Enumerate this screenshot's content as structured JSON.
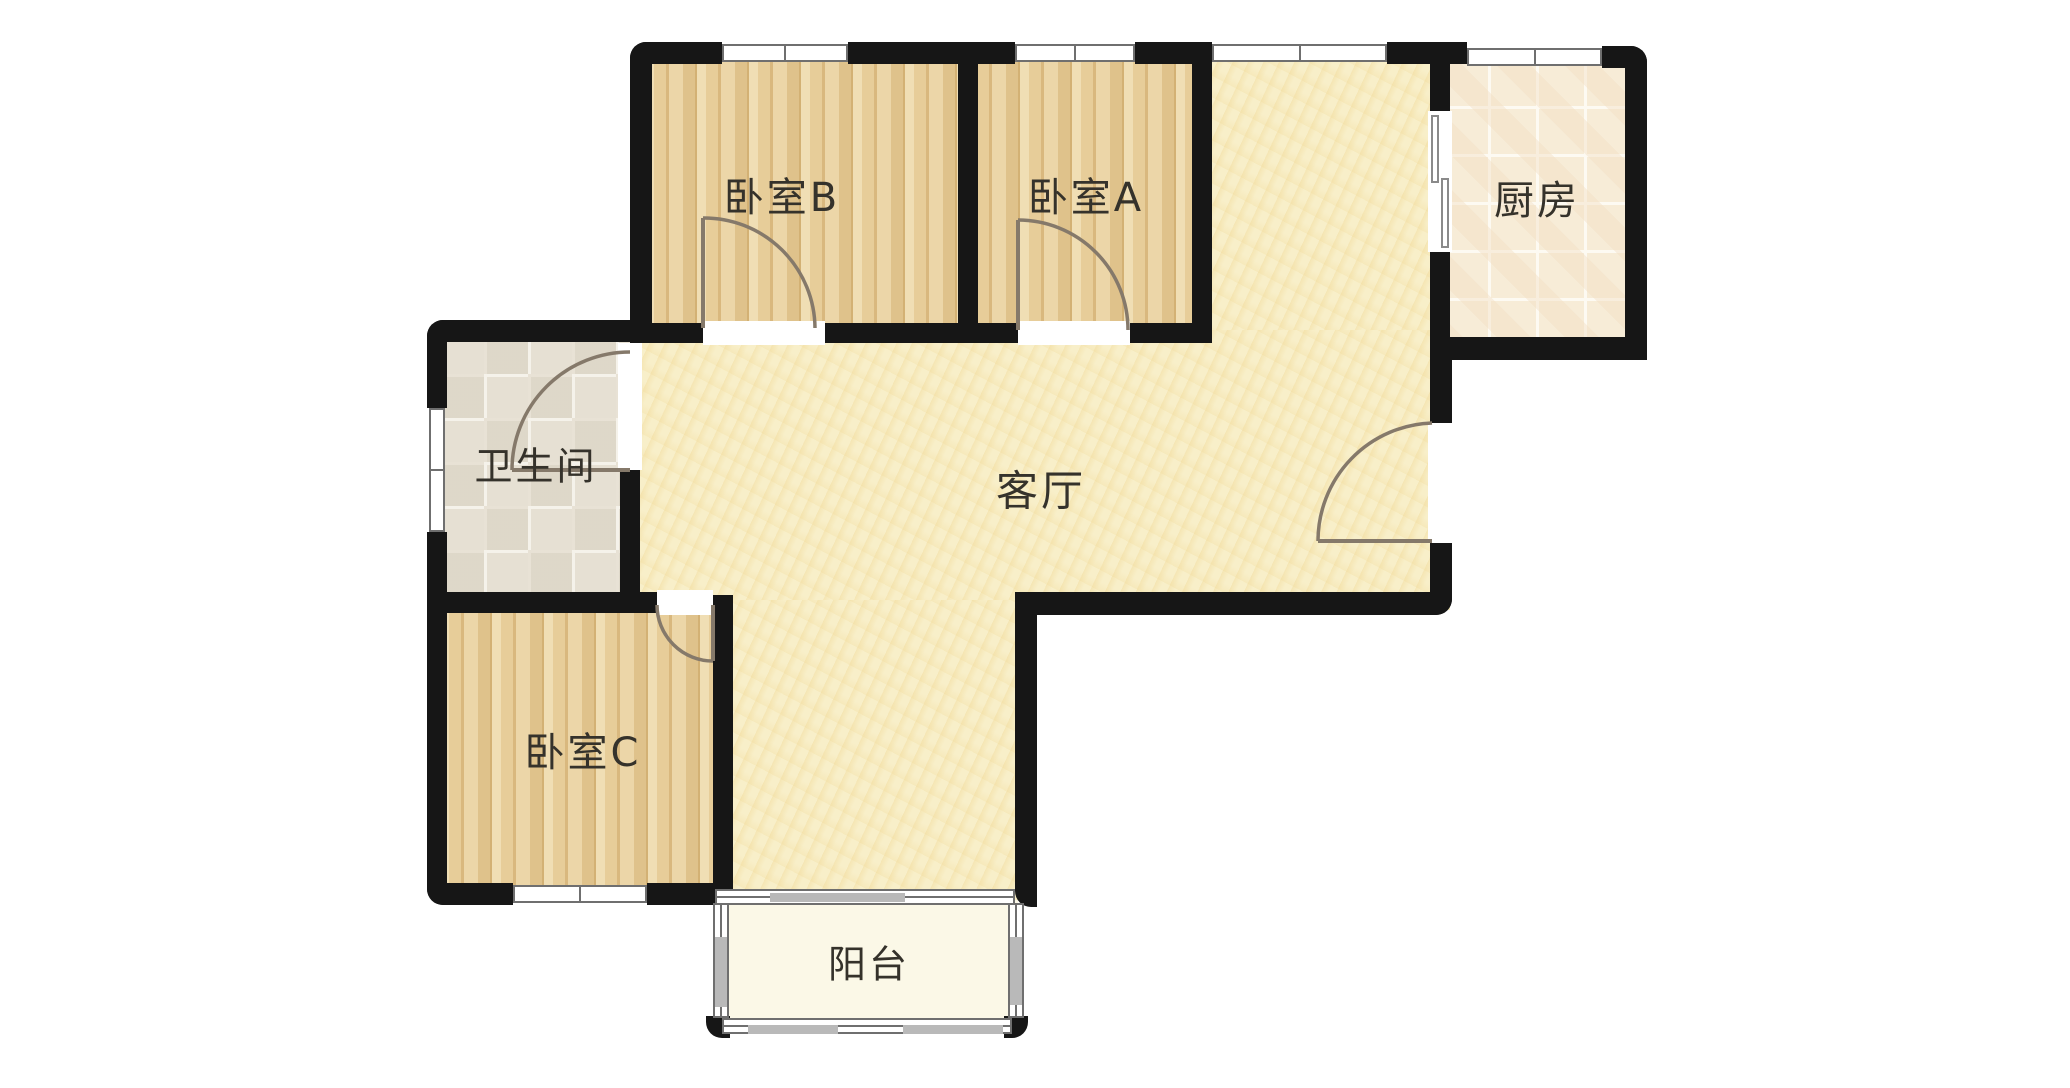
{
  "meta": {
    "type": "apartment-floor-plan",
    "canvas_w": 2070,
    "canvas_h": 1088
  },
  "colors": {
    "background": "#ffffff",
    "wall": "#161616",
    "window_frame": "#6f6f6f",
    "window_glass": "#b9b9b9",
    "door_stroke": "#85796a",
    "label_text": "#35322b",
    "wood_floor": "#e9d2a2",
    "living_floor": "#f8efc9",
    "kitchen_tile": "#f7ecd7",
    "bath_tile": "#e6e0d3",
    "balcony_floor": "#fbf8e7"
  },
  "rooms": [
    {
      "id": "bedroom-b",
      "label": "卧室B",
      "floor": "wood",
      "rects": [
        [
          645,
          50,
          325,
          285
        ]
      ],
      "label_pos": [
        782,
        194
      ],
      "font": 40
    },
    {
      "id": "bedroom-a",
      "label": "卧室A",
      "floor": "wood",
      "rects": [
        [
          968,
          50,
          240,
          285
        ]
      ],
      "label_pos": [
        1086,
        194
      ],
      "font": 40
    },
    {
      "id": "kitchen",
      "label": "厨房",
      "floor": "kitchen",
      "rects": [
        [
          1440,
          58,
          195,
          290
        ]
      ],
      "label_pos": [
        1537,
        197
      ],
      "font": 40
    },
    {
      "id": "living-room",
      "label": "客厅",
      "floor": "living",
      "rects": [
        [
          1205,
          55,
          245,
          555
        ],
        [
          640,
          330,
          810,
          275
        ],
        [
          725,
          600,
          302,
          300
        ]
      ],
      "label_pos": [
        1041,
        488
      ],
      "font": 42
    },
    {
      "id": "bathroom",
      "label": "卫生间",
      "floor": "bath",
      "rects": [
        [
          440,
          330,
          192,
          272
        ]
      ],
      "label_pos": [
        536,
        463
      ],
      "font": 38
    },
    {
      "id": "bedroom-c",
      "label": "卧室C",
      "floor": "wood",
      "rects": [
        [
          440,
          598,
          285,
          295
        ]
      ],
      "label_pos": [
        583,
        749
      ],
      "font": 40
    },
    {
      "id": "balcony",
      "label": "阳台",
      "floor": "balcony",
      "rects": [
        [
          726,
          900,
          292,
          126
        ]
      ],
      "label_pos": [
        869,
        961
      ],
      "font": 38
    }
  ],
  "walls": [
    {
      "r": [
        630,
        42,
        92,
        22
      ],
      "round": "tl"
    },
    {
      "r": [
        630,
        42,
        22,
        288
      ],
      "round": "tl"
    },
    {
      "r": [
        848,
        42,
        167,
        22
      ]
    },
    {
      "r": [
        1135,
        42,
        77,
        22
      ]
    },
    {
      "r": [
        1387,
        42,
        80,
        22
      ]
    },
    {
      "r": [
        1602,
        46,
        45,
        22
      ],
      "round": "tr"
    },
    {
      "r": [
        1625,
        46,
        22,
        314
      ],
      "round": "tr"
    },
    {
      "r": [
        958,
        42,
        20,
        301
      ]
    },
    {
      "r": [
        1192,
        42,
        20,
        301
      ]
    },
    {
      "r": [
        630,
        323,
        73,
        20
      ]
    },
    {
      "r": [
        825,
        323,
        133,
        20
      ]
    },
    {
      "r": [
        958,
        323,
        60,
        20
      ]
    },
    {
      "r": [
        1130,
        323,
        82,
        20
      ]
    },
    {
      "r": [
        1430,
        42,
        20,
        71
      ]
    },
    {
      "r": [
        1430,
        250,
        20,
        117
      ]
    },
    {
      "r": [
        1430,
        337,
        217,
        23
      ],
      "round": "br"
    },
    {
      "r": [
        1430,
        360,
        22,
        63
      ]
    },
    {
      "r": [
        1430,
        543,
        22,
        72
      ],
      "round": "br"
    },
    {
      "r": [
        1015,
        592,
        437,
        23
      ],
      "round": "br"
    },
    {
      "r": [
        1015,
        592,
        22,
        315
      ],
      "round": "bl"
    },
    {
      "r": [
        713,
        595,
        20,
        310
      ]
    },
    {
      "r": [
        427,
        320,
        223,
        22
      ],
      "round": "tl"
    },
    {
      "r": [
        427,
        320,
        20,
        88
      ],
      "round": "tl"
    },
    {
      "r": [
        427,
        532,
        20,
        62
      ]
    },
    {
      "r": [
        620,
        470,
        20,
        124
      ]
    },
    {
      "r": [
        427,
        592,
        230,
        21
      ]
    },
    {
      "r": [
        427,
        592,
        20,
        313
      ],
      "round": "bl"
    },
    {
      "r": [
        427,
        883,
        86,
        22
      ],
      "round": "bl"
    },
    {
      "r": [
        647,
        883,
        70,
        22
      ]
    },
    {
      "r": [
        706,
        1016,
        24,
        22
      ],
      "round": "bl"
    },
    {
      "r": [
        1004,
        1016,
        24,
        22
      ],
      "round": "br"
    }
  ],
  "openings": [
    {
      "id": "bedroom-b-doorway",
      "r": [
        703,
        321,
        122,
        24
      ]
    },
    {
      "id": "bedroom-a-doorway",
      "r": [
        1018,
        321,
        112,
        24
      ]
    },
    {
      "id": "bedroom-c-doorway",
      "r": [
        657,
        590,
        56,
        25
      ]
    },
    {
      "id": "bathroom-doorway",
      "r": [
        618,
        343,
        24,
        127
      ]
    },
    {
      "id": "entry-doorway",
      "r": [
        1428,
        423,
        26,
        120
      ]
    }
  ],
  "windows": [
    {
      "id": "bedroom-b-window",
      "r": [
        722,
        44,
        126,
        18
      ],
      "dir": "h",
      "tick": true
    },
    {
      "id": "bedroom-a-window",
      "r": [
        1015,
        44,
        120,
        18
      ],
      "dir": "h",
      "tick": true
    },
    {
      "id": "living-window",
      "r": [
        1212,
        44,
        175,
        18
      ],
      "dir": "h",
      "tick": true
    },
    {
      "id": "kitchen-window",
      "r": [
        1467,
        48,
        135,
        18
      ],
      "dir": "h",
      "tick": true
    },
    {
      "id": "bathroom-window",
      "r": [
        429,
        408,
        16,
        124
      ],
      "dir": "v",
      "tick": true
    },
    {
      "id": "bedroom-c-window",
      "r": [
        513,
        885,
        134,
        18
      ],
      "dir": "h",
      "tick": true
    },
    {
      "id": "balcony-window-top",
      "r": [
        715,
        889,
        300,
        16
      ],
      "dir": "h",
      "mid": true
    },
    {
      "id": "balcony-window-left",
      "r": [
        713,
        903,
        16,
        115
      ],
      "dir": "v",
      "mid": true
    },
    {
      "id": "balcony-window-bottom",
      "r": [
        722,
        1018,
        290,
        16
      ],
      "dir": "h",
      "mid": true
    },
    {
      "id": "balcony-window-right",
      "r": [
        1008,
        903,
        16,
        115
      ],
      "dir": "v",
      "mid": true
    }
  ],
  "glass_segments": [
    [
      770,
      893,
      135,
      9
    ],
    [
      748,
      1025,
      90,
      9
    ],
    [
      903,
      1025,
      100,
      9
    ],
    [
      715,
      937,
      12,
      70
    ],
    [
      1010,
      937,
      12,
      68
    ]
  ],
  "doors": [
    {
      "name": "bedroom-b-door",
      "leaf": [
        703,
        328,
        703,
        218
      ],
      "arc_from": [
        703,
        218
      ],
      "arc_to": [
        815,
        328
      ],
      "radius": 111,
      "sweep": 1
    },
    {
      "name": "bedroom-a-door",
      "leaf": [
        1018,
        330,
        1018,
        220
      ],
      "arc_from": [
        1018,
        220
      ],
      "arc_to": [
        1128,
        330
      ],
      "radius": 110,
      "sweep": 1
    },
    {
      "name": "bedroom-c-door",
      "leaf": [
        713,
        605,
        713,
        661
      ],
      "arc_from": [
        657,
        605
      ],
      "arc_to": [
        713,
        661
      ],
      "radius": 56,
      "sweep": 0
    },
    {
      "name": "bathroom-door",
      "leaf": [
        630,
        470,
        512,
        470
      ],
      "arc_from": [
        630,
        352
      ],
      "arc_to": [
        512,
        470
      ],
      "radius": 118,
      "sweep": 0
    },
    {
      "name": "entry-door",
      "leaf": [
        1432,
        541,
        1318,
        541
      ],
      "arc_from": [
        1432,
        423
      ],
      "arc_to": [
        1318,
        541
      ],
      "radius": 118,
      "sweep": 0
    }
  ],
  "sliding_door": {
    "id": "kitchen-sliding-door",
    "bg": [
      1428,
      111,
      24,
      141
    ],
    "panels": [
      [
        1431,
        115,
        8,
        68
      ],
      [
        1441,
        178,
        8,
        70
      ]
    ]
  }
}
